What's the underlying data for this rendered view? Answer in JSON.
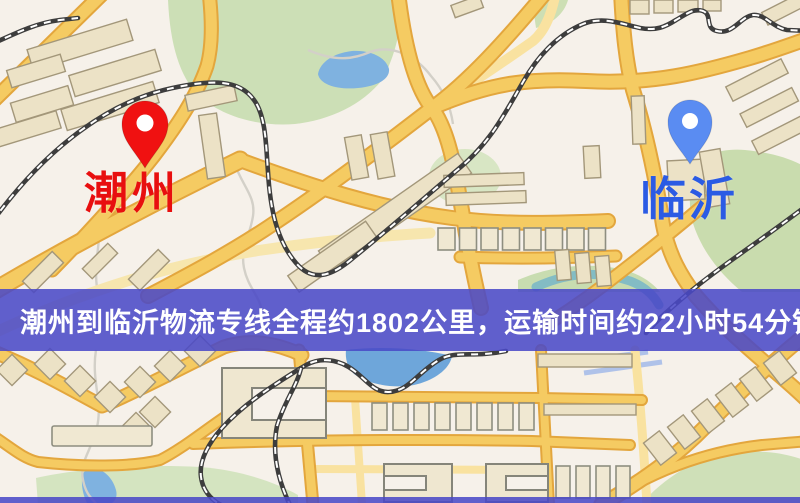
{
  "banner": {
    "text": "潮州到临沂物流专线全程约1802公里，运输时间约22小时54分钟.",
    "bg_color": "rgba(74,72,199,0.87)",
    "text_color": "#ffffff"
  },
  "markers": {
    "origin": {
      "name": "潮州",
      "pin_color": "#f01111",
      "inner_dot_color": "#ffffff",
      "label_color": "#e80f0f"
    },
    "destination": {
      "name": "临沂",
      "pin_color": "#5a8cf2",
      "inner_dot_color": "#ffffff",
      "label_color": "#2b5be4"
    }
  },
  "map_palette": {
    "background": "#f6f1ea",
    "park_green": "#cddfb4",
    "water_blue": "#7fb2e0",
    "road_fill": "#f5cb62",
    "road_casing": "#e3a63d",
    "road_minor": "#f9e2a0",
    "railway_dark": "#3d3d3d",
    "railway_dash": "#ffffff",
    "building_fill": "#ece2c6",
    "building_stroke": "#a3977a",
    "bottom_strip_color": "rgba(74,72,199,0.87)"
  }
}
